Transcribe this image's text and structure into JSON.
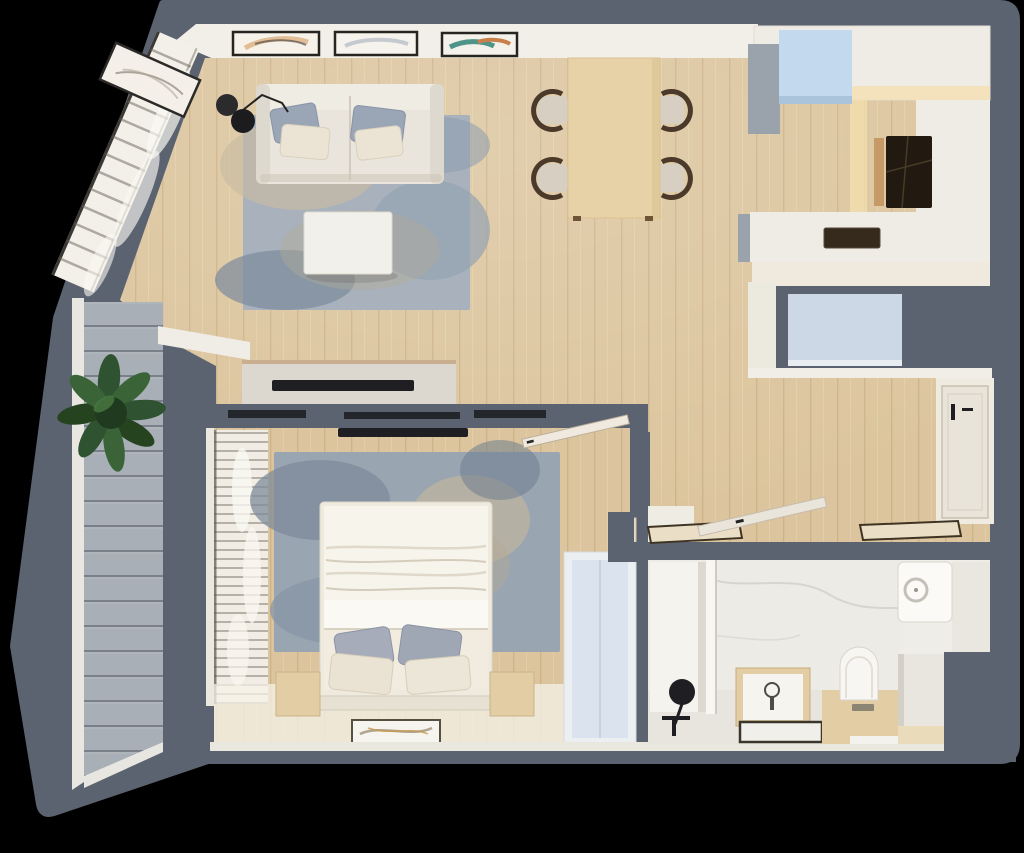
{
  "scene": {
    "type": "3d-floor-plan-top-view",
    "description": "Photorealistic top-down render of a one-bedroom apartment with balcony",
    "background": "#000000"
  },
  "colors": {
    "wall": "#5b6370",
    "wood": "#dcc59e",
    "deck": "#a8afb6",
    "white_trim": "#f1eee7",
    "marble": "#edebe6",
    "glow": "#f4dfae",
    "rug_living": "#a9b2bc",
    "rug_bedroom": "#9aa5b2",
    "sofa": "#e9e5dc",
    "bedding": "#f7f4ec",
    "light_wood": "#e7d2a8",
    "furniture_wood": "#e2cda4",
    "appliance_blue": "#c3d9ed",
    "closet_blue": "#ccd8e6",
    "wardrobe_blue": "#dae3ee",
    "plant": "#2f5331",
    "dark_fixture": "#1f1f23"
  },
  "rooms": [
    {
      "id": "living-room",
      "furniture": [
        "sofa with pillows",
        "area rug",
        "coffee table",
        "floor lamp",
        "tv sideboard",
        "wall art frames",
        "window curtain wall"
      ]
    },
    {
      "id": "dining-area",
      "furniture": [
        "wooden dining table",
        "four chairs"
      ]
    },
    {
      "id": "kitchen",
      "furniture": [
        "u-shaped counter",
        "fridge",
        "induction cooktop",
        "sink",
        "blue closet"
      ]
    },
    {
      "id": "hallway",
      "furniture": [
        "entrance door",
        "two door mats"
      ]
    },
    {
      "id": "bedroom",
      "furniture": [
        "double bed",
        "two nightstands",
        "area rug",
        "wardrobe",
        "tv",
        "curtains",
        "floor mat"
      ]
    },
    {
      "id": "bathroom",
      "furniture": [
        "shower with black fixtures",
        "vanity sink",
        "toilet on wooden platform",
        "washing machine",
        "marble counters"
      ]
    },
    {
      "id": "balcony",
      "furniture": [
        "gray plank decking",
        "green plant"
      ]
    }
  ]
}
